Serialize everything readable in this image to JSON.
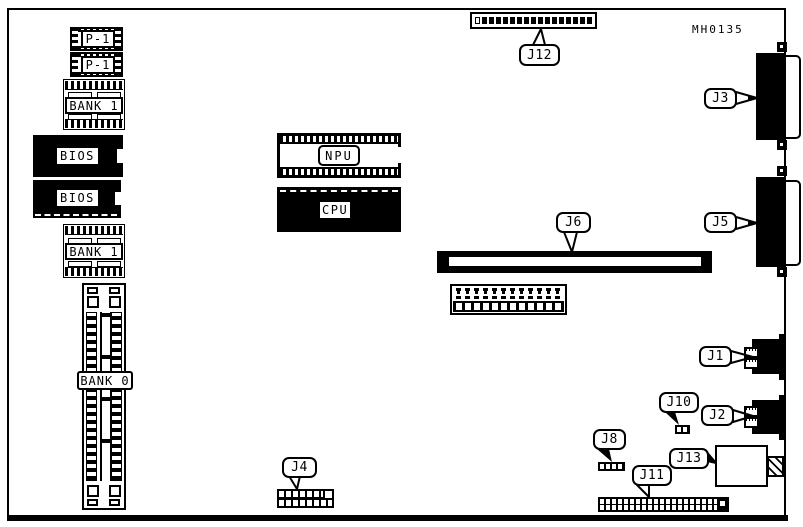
{
  "part_number": "MH0135",
  "chips": {
    "p1_top": {
      "label": "P-1"
    },
    "p1_bottom": {
      "label": "P-1"
    },
    "bank1_top": {
      "label": "BANK 1"
    },
    "bios_top": {
      "label": "BIOS"
    },
    "bios_bottom": {
      "label": "BIOS"
    },
    "bank1_bottom": {
      "label": "BANK 1"
    },
    "bank0": {
      "label": "BANK 0"
    },
    "npu": {
      "label": "NPU"
    },
    "cpu": {
      "label": "CPU"
    }
  },
  "connectors": {
    "j1": {
      "label": "J1"
    },
    "j2": {
      "label": "J2"
    },
    "j3": {
      "label": "J3"
    },
    "j4": {
      "label": "J4"
    },
    "j5": {
      "label": "J5"
    },
    "j6": {
      "label": "J6"
    },
    "j8": {
      "label": "J8"
    },
    "j10": {
      "label": "J10"
    },
    "j11": {
      "label": "J11"
    },
    "j12": {
      "label": "J12"
    },
    "j13": {
      "label": "J13"
    }
  }
}
